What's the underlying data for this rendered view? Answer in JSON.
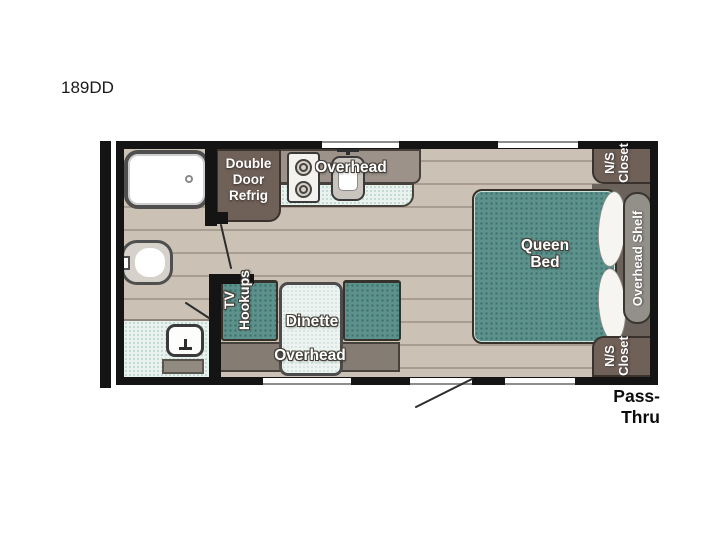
{
  "title": "189DD",
  "plan": {
    "kitchen": {
      "refrig_lines": [
        "Double",
        "Door",
        "Refrig"
      ],
      "overhead_label": "Overhead"
    },
    "dinette": {
      "label": "Dinette",
      "overhead_label": "Overhead",
      "tv_hookups_lines": [
        "TV",
        "Hookups"
      ]
    },
    "bedroom": {
      "bed_lines": [
        "Queen",
        "Bed"
      ],
      "closet_top_lines": [
        "N/S",
        "Closet"
      ],
      "closet_bottom_lines": [
        "N/S",
        "Closet"
      ],
      "shelf_label": "Overhead Shelf"
    },
    "exterior": {
      "pass_thru_label": "Pass-Thru"
    },
    "fixtures": [
      "shower",
      "toilet",
      "vanity-sink",
      "two-burner-stove",
      "kitchen-sink",
      "double-door-refrigerator",
      "dinette-table",
      "queen-bed",
      "rear-bumper"
    ]
  },
  "colors": {
    "wall": "#141414",
    "floor": "#cbc2b5",
    "plank_line": "#a89d90",
    "upholstery_teal": "#5d918c",
    "upholstery_dot": "#3c6e69",
    "bath_mint": "#e9f2ee",
    "cabinet_brown": "#6f6058",
    "overhead_gray": "#9c9289",
    "shelf_gray": "#93908a"
  }
}
